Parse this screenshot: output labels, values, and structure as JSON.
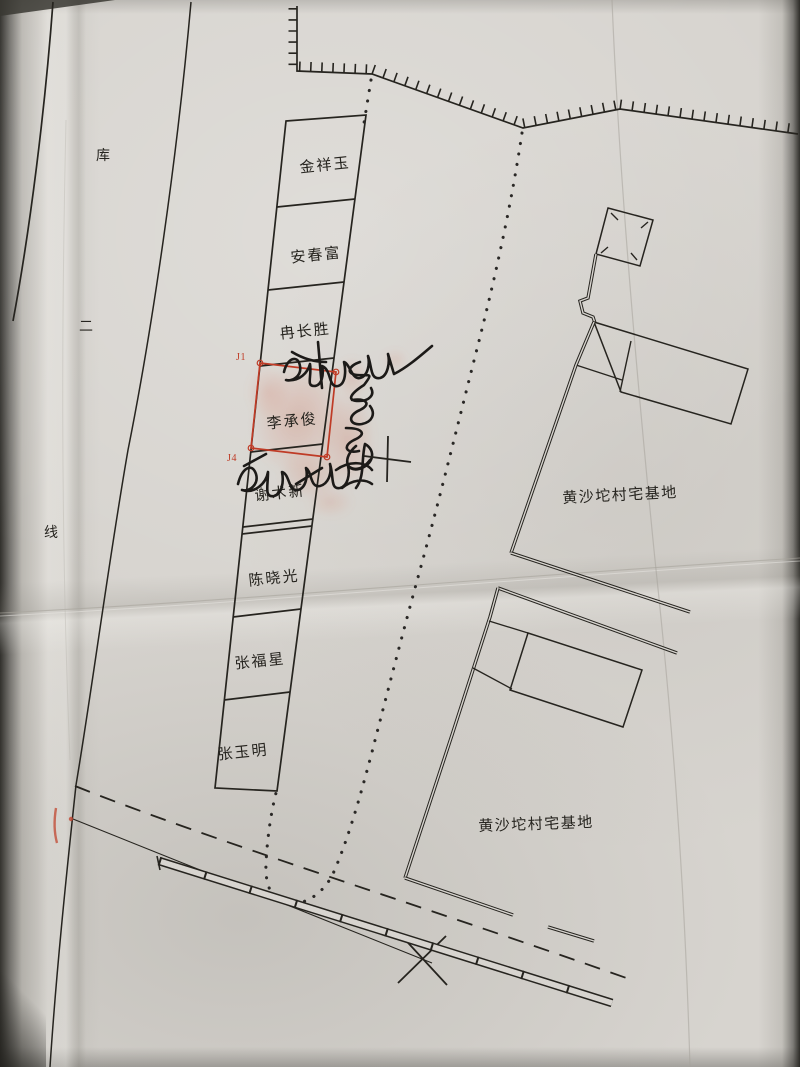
{
  "labels": {
    "boundary_name": "库二线",
    "boundary_chars": [
      "库",
      "二",
      "线"
    ]
  },
  "plots": [
    {
      "owner": "金祥玉"
    },
    {
      "owner": "安春富"
    },
    {
      "owner": "冉长胜"
    },
    {
      "owner": "李承俊"
    },
    {
      "owner": "谢术新"
    },
    {
      "owner": "陈晓光"
    },
    {
      "owner": "张福星"
    },
    {
      "owner": "张玉明"
    }
  ],
  "markers": {
    "j1": "J1",
    "j4": "J4"
  },
  "areas": [
    {
      "name": "黄沙坨村宅基地"
    },
    {
      "name": "黄沙坨村宅基地"
    }
  ],
  "signatures": [
    {
      "text": "冉长胜",
      "medium": "handwritten ink",
      "orientation": "horizontal"
    },
    {
      "text": "安春富",
      "medium": "handwritten ink",
      "orientation": "vertical"
    },
    {
      "text": "谢术新",
      "medium": "handwritten ink",
      "orientation": "horizontal"
    }
  ],
  "stamps": [
    {
      "kind": "red fingerprint smudge",
      "location": "over plot 李承俊 / red survey square"
    }
  ],
  "colors": {
    "paper": "#d7d4cf",
    "ink": "#26241f",
    "red_marker": "#bf3b26",
    "fingerprint": "#cf6a52",
    "crease": "#a6a39b"
  }
}
